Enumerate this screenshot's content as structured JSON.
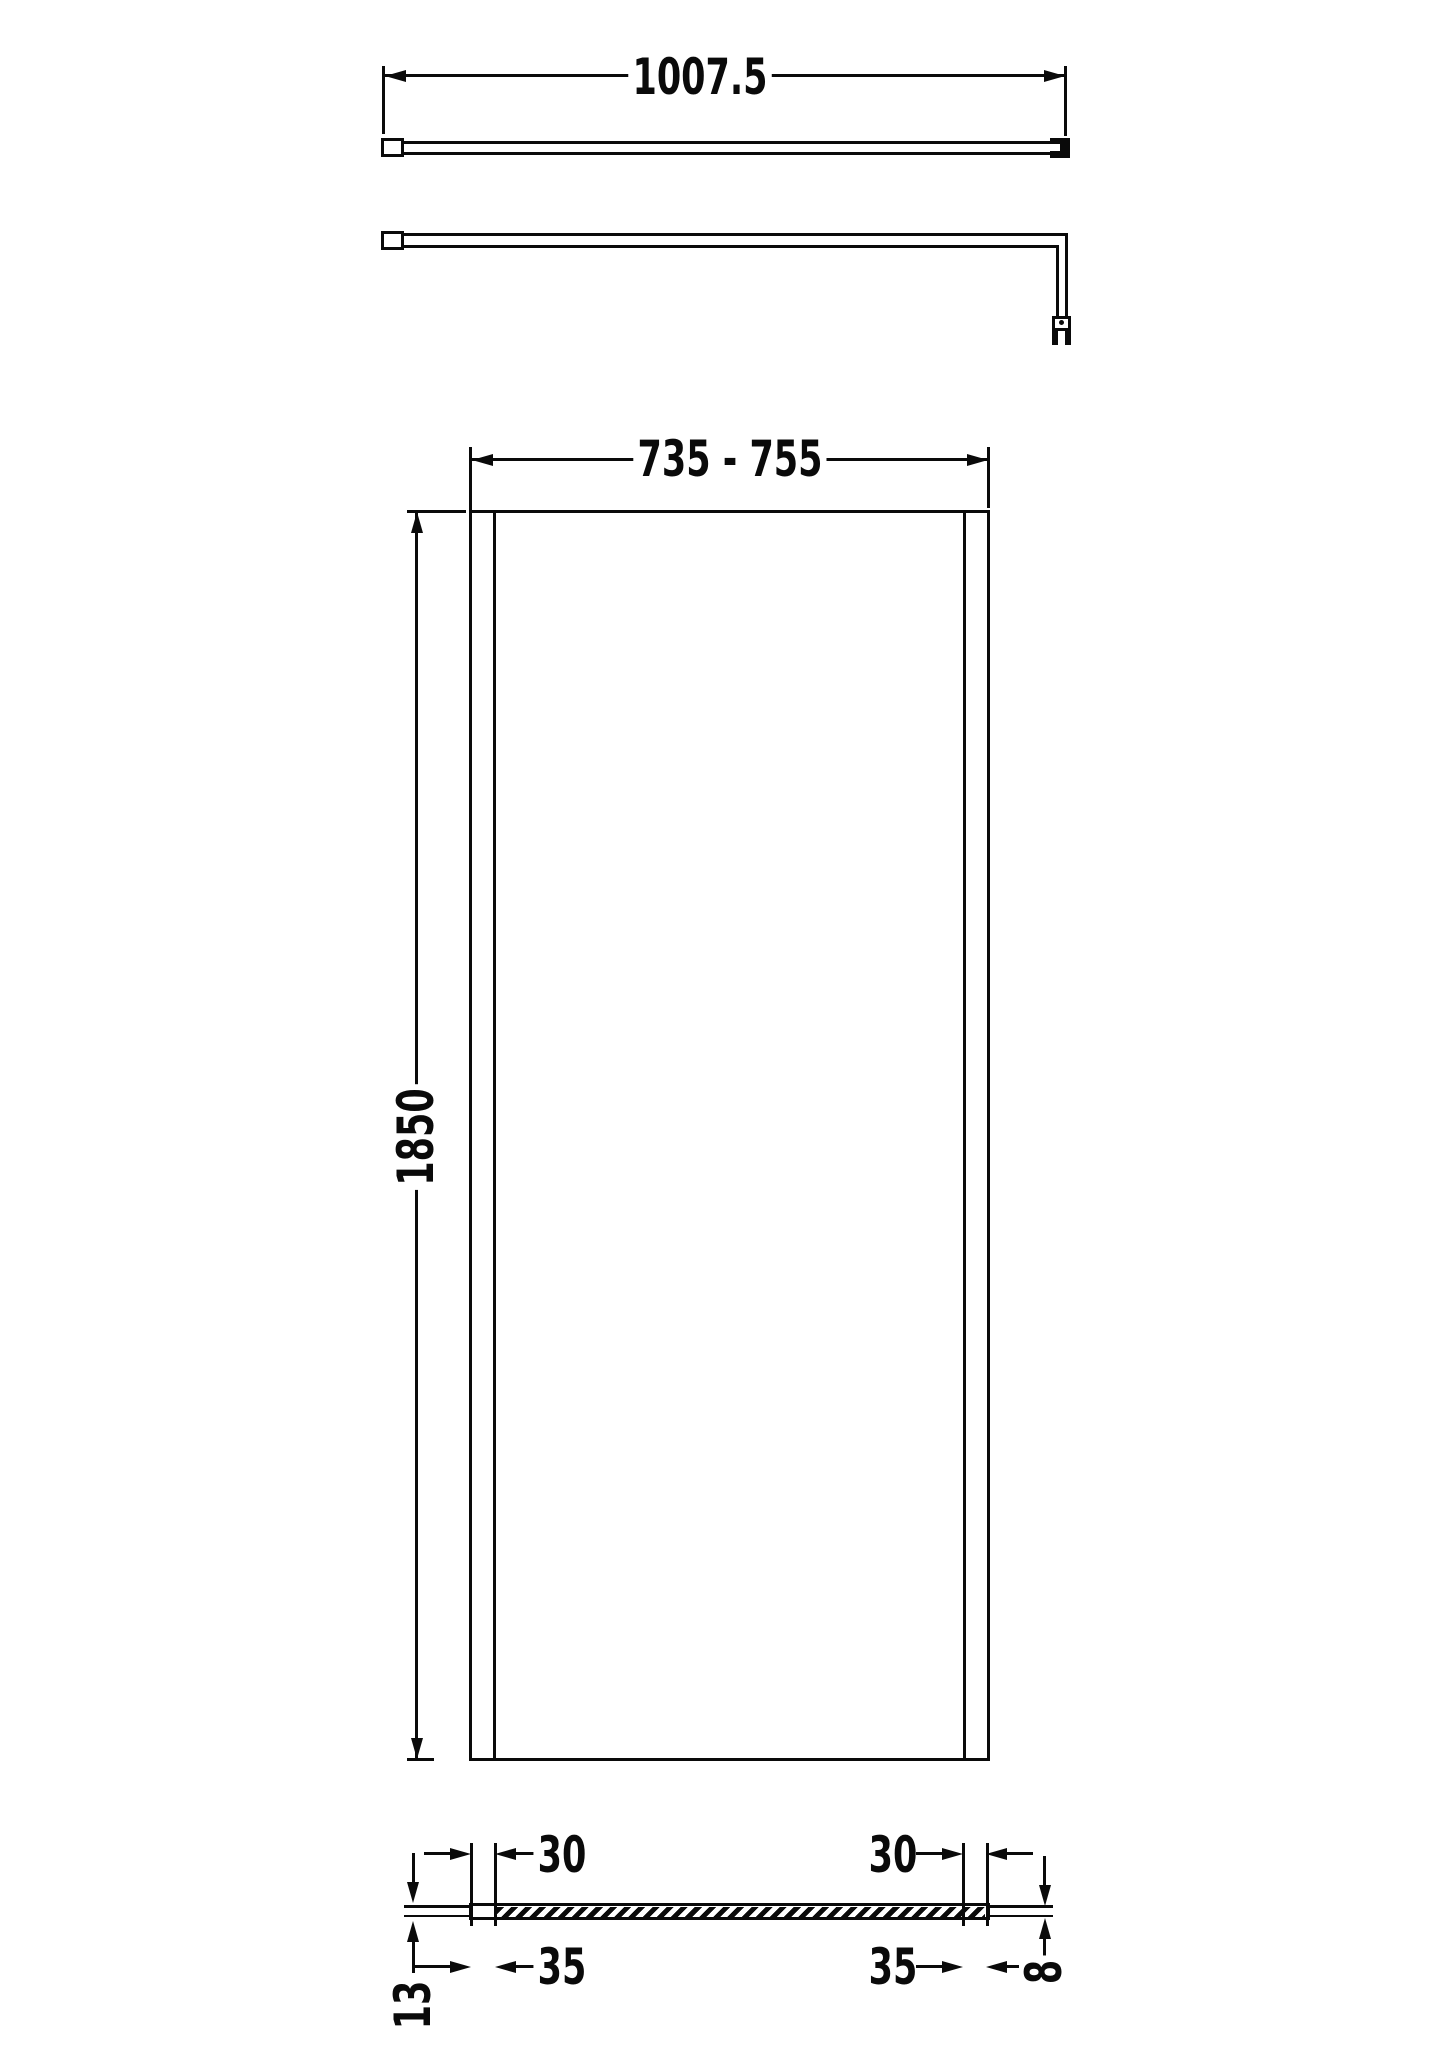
{
  "drawing": {
    "type": "technical-dimension-drawing",
    "subject": "wetroom shower screen with support bar",
    "colors": {
      "line": "#0a0a0a",
      "background": "#ffffff"
    },
    "dimensions": {
      "support_bar_length": "1007.5",
      "panel_width_range": "735 - 755",
      "panel_height": "1850",
      "profile_cap_width": "30",
      "profile_overall_width": "35",
      "wall_profile_depth": "13",
      "glass_thickness": "8"
    }
  }
}
